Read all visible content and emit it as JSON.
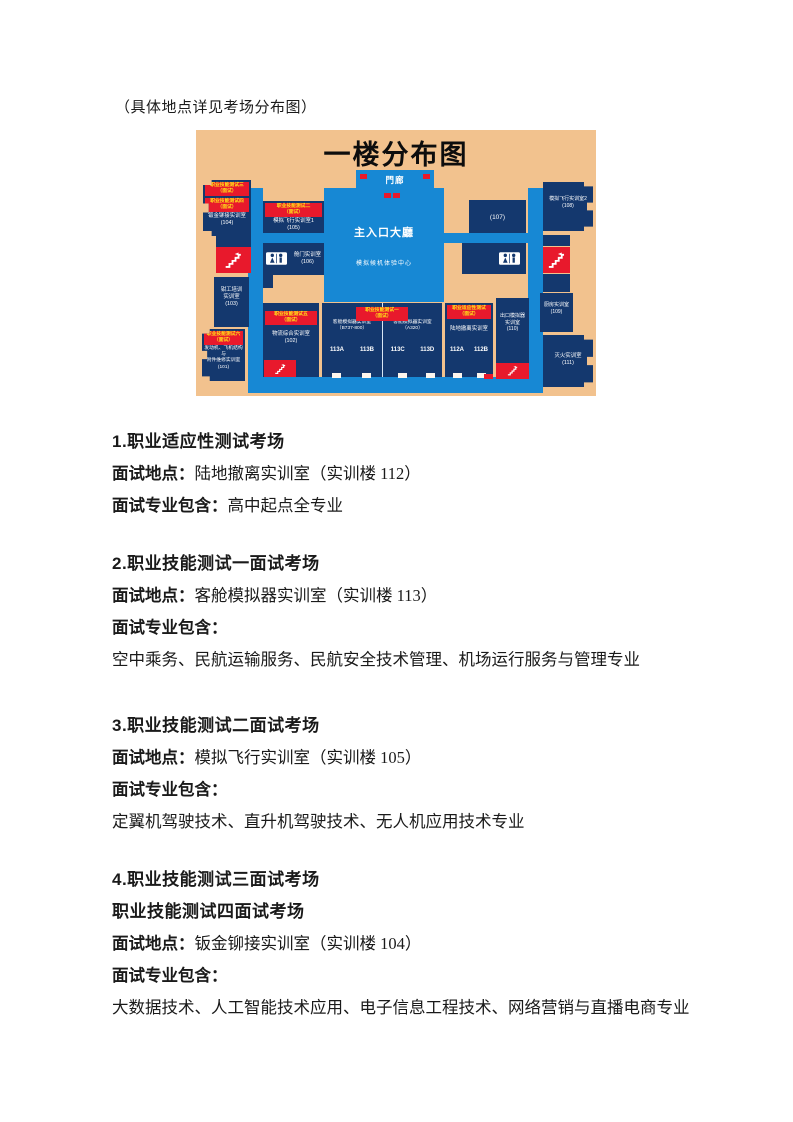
{
  "intro": "（具体地点详见考场分布图）",
  "map": {
    "title": "一楼分布图",
    "areas": {
      "porch": "門廊",
      "hall": "主入口大廳",
      "experience_center": "模拟候机体验中心"
    },
    "rooms": {
      "r104": {
        "banners": [
          "职业技能测试三\n（面试）",
          "职业技能测试四\n（面试）"
        ],
        "name": "钣金铆接实训室\n(104)"
      },
      "r103": {
        "name": "钳工培训\n实训室\n(103)"
      },
      "r101": {
        "banner": "职业技能测试六\n（面试）",
        "name": "发动机、飞机结构与\n附件维修实训室\n(101)"
      },
      "r105": {
        "banner": "职业技能测试二\n（面试）",
        "name": "模拟飞行实训室1\n(105)"
      },
      "r106": {
        "name": "舱门实训室\n(106)"
      },
      "r102": {
        "banner": "职业技能测试五\n（面试）",
        "name": "物流综合实训室\n(102)"
      },
      "r113": {
        "banner": "职业技能测试一\n（面试）",
        "left_name": "客舱模拟器实训室\n（B737-800）",
        "right_name": "客舱模拟器实训室\n（A320）",
        "cells": [
          "113A",
          "113B",
          "113C",
          "113D"
        ]
      },
      "r112": {
        "banner": "职业适应性测试\n（面试）",
        "name": "陆地撤离实训室",
        "cells": [
          "112A",
          "112B"
        ]
      },
      "r110": {
        "name": "出口模拟器\n实训室\n(110)"
      },
      "r107": {
        "name": "(107)"
      },
      "r108": {
        "name": "模拟飞行实训室2\n(108)"
      },
      "r109": {
        "name": "厨房实训室\n(109)"
      },
      "r111": {
        "name": "灭火实训室\n(111)"
      }
    },
    "colors": {
      "background": "#f2c28e",
      "room": "#14386e",
      "corridor": "#1788d4",
      "stairs_red": "#e8192c",
      "banner_text": "#ffe318"
    }
  },
  "sections": [
    {
      "heading": "1.职业适应性测试考场",
      "location_label": "面试地点：",
      "location": "陆地撤离实训室（实训楼 112）",
      "majors_label": "面试专业包含：",
      "majors_inline": "高中起点全专业"
    },
    {
      "heading": "2.职业技能测试一面试考场",
      "location_label": "面试地点：",
      "location": "客舱模拟器实训室（实训楼 113）",
      "majors_label": "面试专业包含：",
      "majors_block": "空中乘务、民航运输服务、民航安全技术管理、机场运行服务与管理专业"
    },
    {
      "heading": "3.职业技能测试二面试考场",
      "location_label": "面试地点：",
      "location": "模拟飞行实训室（实训楼 105）",
      "majors_label": "面试专业包含：",
      "majors_block": "定翼机驾驶技术、直升机驾驶技术、无人机应用技术专业"
    },
    {
      "heading": "4.职业技能测试三面试考场",
      "heading2": "职业技能测试四面试考场",
      "location_label": "面试地点：",
      "location": "钣金铆接实训室（实训楼 104）",
      "majors_label": "面试专业包含：",
      "majors_block": "大数据技术、人工智能技术应用、电子信息工程技术、网络营销与直播电商专业"
    }
  ]
}
